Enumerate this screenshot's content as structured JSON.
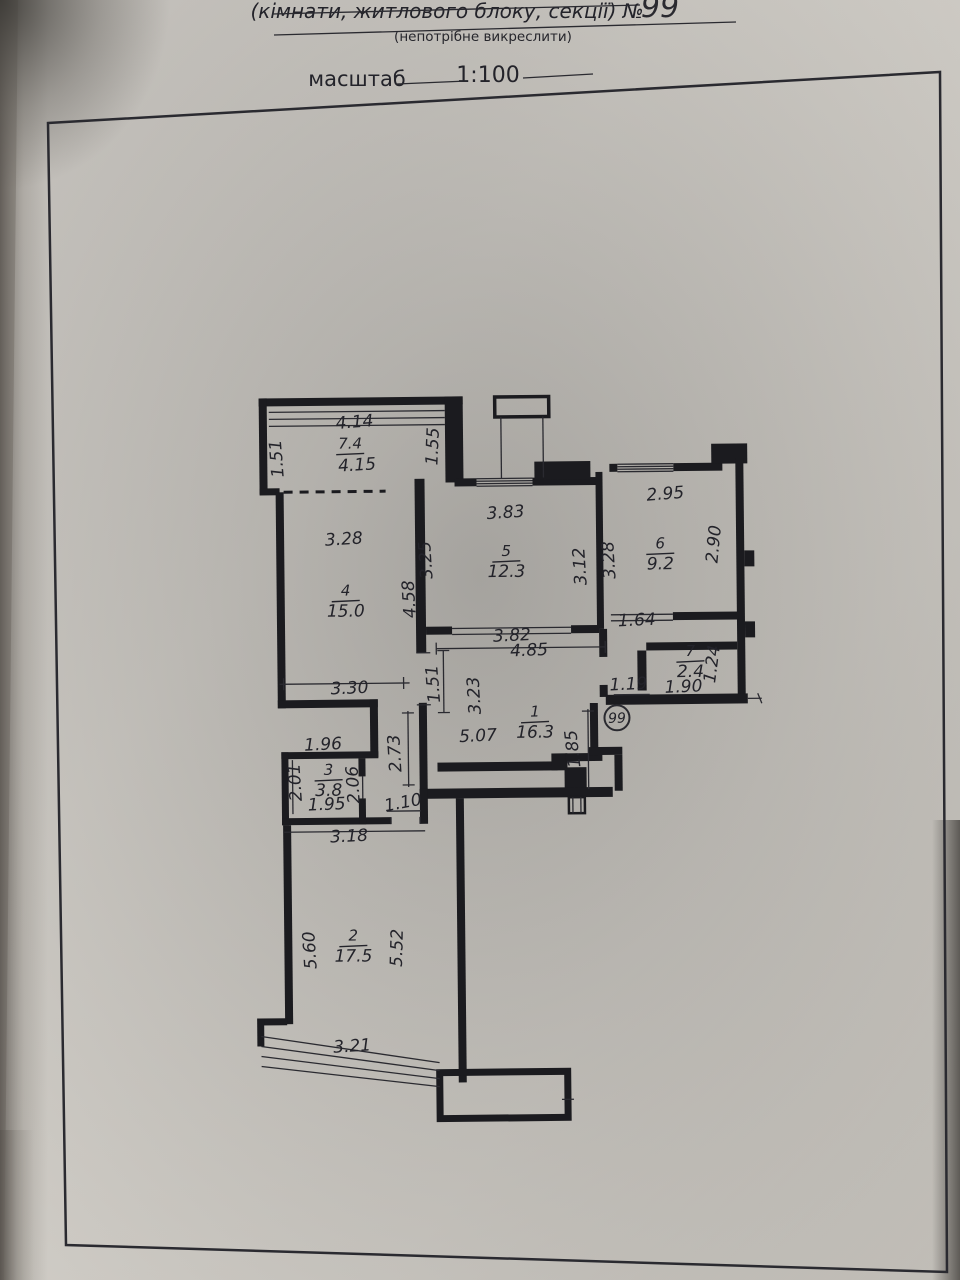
{
  "document": {
    "header": {
      "line1": "(кімнати, житлового блоку, секції)  №",
      "number": "99",
      "line2": "(непотрібне викреслити)",
      "scale_label": "масштаб",
      "scale_value": "1:100"
    }
  },
  "plan": {
    "badge": "99",
    "rooms": [
      {
        "id": "balcony",
        "num": "7.4",
        "area": "",
        "x": 353,
        "y": 452
      },
      {
        "id": "room-4",
        "num": "4",
        "area": "15.0",
        "x": 347,
        "y": 599
      },
      {
        "id": "room-5",
        "num": "5",
        "area": "12.3",
        "x": 508,
        "y": 561
      },
      {
        "id": "room-6",
        "num": "6",
        "area": "9.2",
        "x": 662,
        "y": 555
      },
      {
        "id": "room-7",
        "num": "7",
        "area": "2.4",
        "x": 691,
        "y": 663
      },
      {
        "id": "room-1",
        "num": "1",
        "area": "16.3",
        "x": 535,
        "y": 722
      },
      {
        "id": "room-3",
        "num": "3",
        "area": "3.8",
        "x": 328,
        "y": 778
      },
      {
        "id": "room-2",
        "num": "2",
        "area": "17.5",
        "x": 351,
        "y": 944
      }
    ],
    "dims": [
      {
        "t": "4.14",
        "x": 358,
        "y": 426,
        "r": -4
      },
      {
        "t": "4.15",
        "x": 360,
        "y": 469,
        "r": -3
      },
      {
        "t": "1.51",
        "x": 285,
        "y": 456,
        "r": -94
      },
      {
        "t": "1.55",
        "x": 441,
        "y": 446,
        "r": -87
      },
      {
        "t": "3.28",
        "x": 346,
        "y": 543,
        "r": -3
      },
      {
        "t": "3.25",
        "x": 433,
        "y": 559,
        "r": -93
      },
      {
        "t": "4.58",
        "x": 416,
        "y": 598,
        "r": -93
      },
      {
        "t": "3.30",
        "x": 350,
        "y": 692,
        "r": -2
      },
      {
        "t": "3.83",
        "x": 508,
        "y": 518,
        "r": -3
      },
      {
        "t": "3.12",
        "x": 587,
        "y": 567,
        "r": -93
      },
      {
        "t": "3.82",
        "x": 513,
        "y": 641,
        "r": -2
      },
      {
        "t": "2.95",
        "x": 668,
        "y": 501,
        "r": -4
      },
      {
        "t": "3.28",
        "x": 616,
        "y": 561,
        "r": -93
      },
      {
        "t": "2.90",
        "x": 721,
        "y": 547,
        "r": -84
      },
      {
        "t": "1.64",
        "x": 638,
        "y": 627,
        "r": -2
      },
      {
        "t": "1.24",
        "x": 718,
        "y": 667,
        "r": -82
      },
      {
        "t": "1.90",
        "x": 684,
        "y": 694,
        "r": -2
      },
      {
        "t": "1.19",
        "x": 629,
        "y": 691,
        "r": -2
      },
      {
        "t": "4.85",
        "x": 530,
        "y": 656,
        "r": -2
      },
      {
        "t": "1.51",
        "x": 439,
        "y": 683,
        "r": -94
      },
      {
        "t": "3.23",
        "x": 480,
        "y": 695,
        "r": -93
      },
      {
        "t": "5.07",
        "x": 478,
        "y": 741,
        "r": -2
      },
      {
        "t": "1.85",
        "x": 578,
        "y": 749,
        "r": -96
      },
      {
        "t": "1.96",
        "x": 323,
        "y": 748,
        "r": -2
      },
      {
        "t": "2.73",
        "x": 400,
        "y": 752,
        "r": -93
      },
      {
        "t": "2.01",
        "x": 300,
        "y": 780,
        "r": -93
      },
      {
        "t": "2.06",
        "x": 358,
        "y": 783,
        "r": -93
      },
      {
        "t": "1.95",
        "x": 326,
        "y": 808,
        "r": -2
      },
      {
        "t": "1.10",
        "x": 403,
        "y": 807,
        "r": -10
      },
      {
        "t": "3.18",
        "x": 348,
        "y": 840,
        "r": -2
      },
      {
        "t": "5.60",
        "x": 313,
        "y": 948,
        "r": -93
      },
      {
        "t": "5.52",
        "x": 400,
        "y": 947,
        "r": -88
      },
      {
        "t": "3.21",
        "x": 349,
        "y": 1050,
        "r": -3
      }
    ]
  }
}
